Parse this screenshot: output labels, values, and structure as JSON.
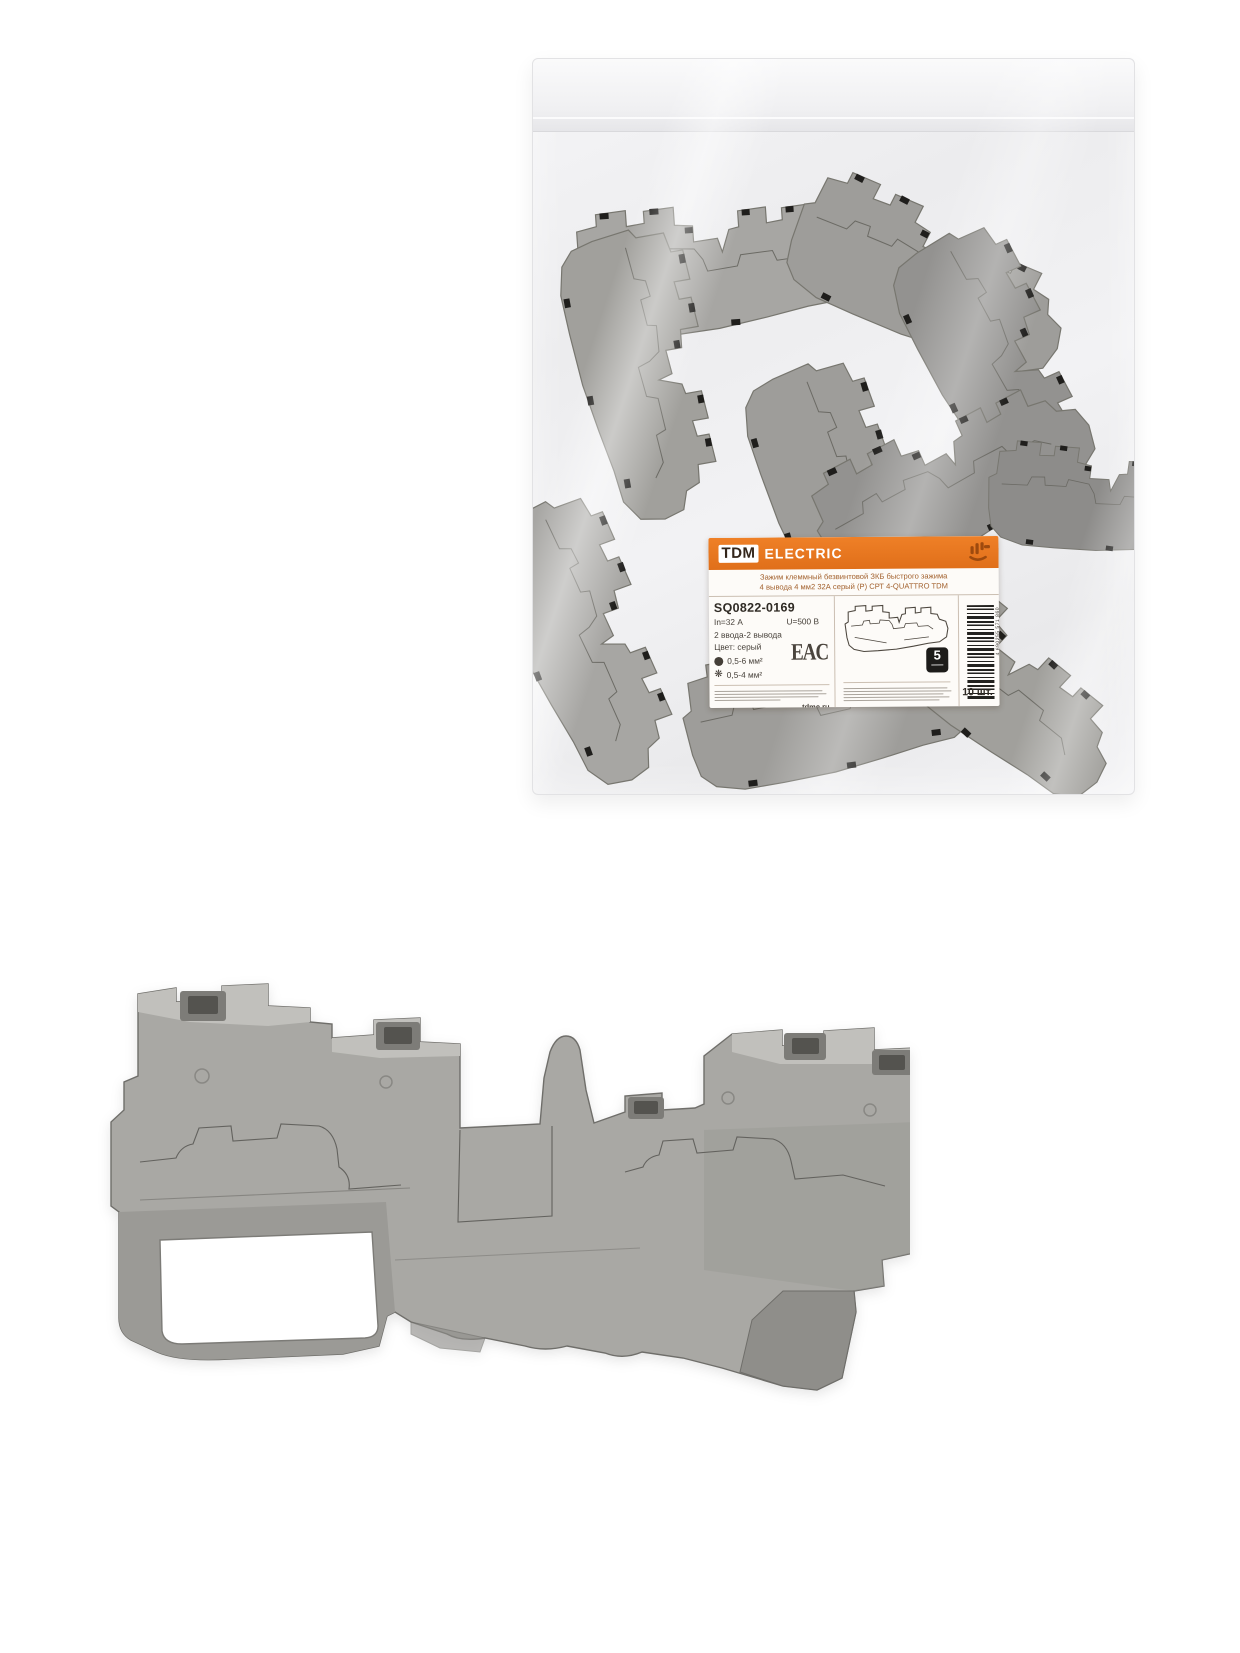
{
  "photo": {
    "subject": "Упаковка клеммных зажимов и клеммный зажим серый"
  },
  "label": {
    "brand": {
      "logo_text": "TDM",
      "name": "ELECTRIC"
    },
    "title_line1": "Зажим клеммный безвинтовой ЗКБ быстрого зажима",
    "title_line2": "4 вывода 4 мм2 32А серый (Р) СРТ 4-QUATTRO TDM",
    "sku": "SQ0822-0169",
    "specs": {
      "current": "In=32 А",
      "voltage": "U=500 В",
      "terminals": "2 ввода-2 вывода",
      "color": "Цвет: серый"
    },
    "wire": {
      "solid_range": "0,5-6 мм²",
      "flex_range": "0,5-4 мм²"
    },
    "cert_mark": "EAC",
    "warranty_years": "5",
    "website": "tdme.ru",
    "barcode_number": "4 690255 571 860",
    "quantity": "10 шт.",
    "colors": {
      "header_orange": "#e87722",
      "title_text": "#a3622f",
      "spec_text": "#453f38",
      "block_gray": "#a9a8a4"
    }
  }
}
